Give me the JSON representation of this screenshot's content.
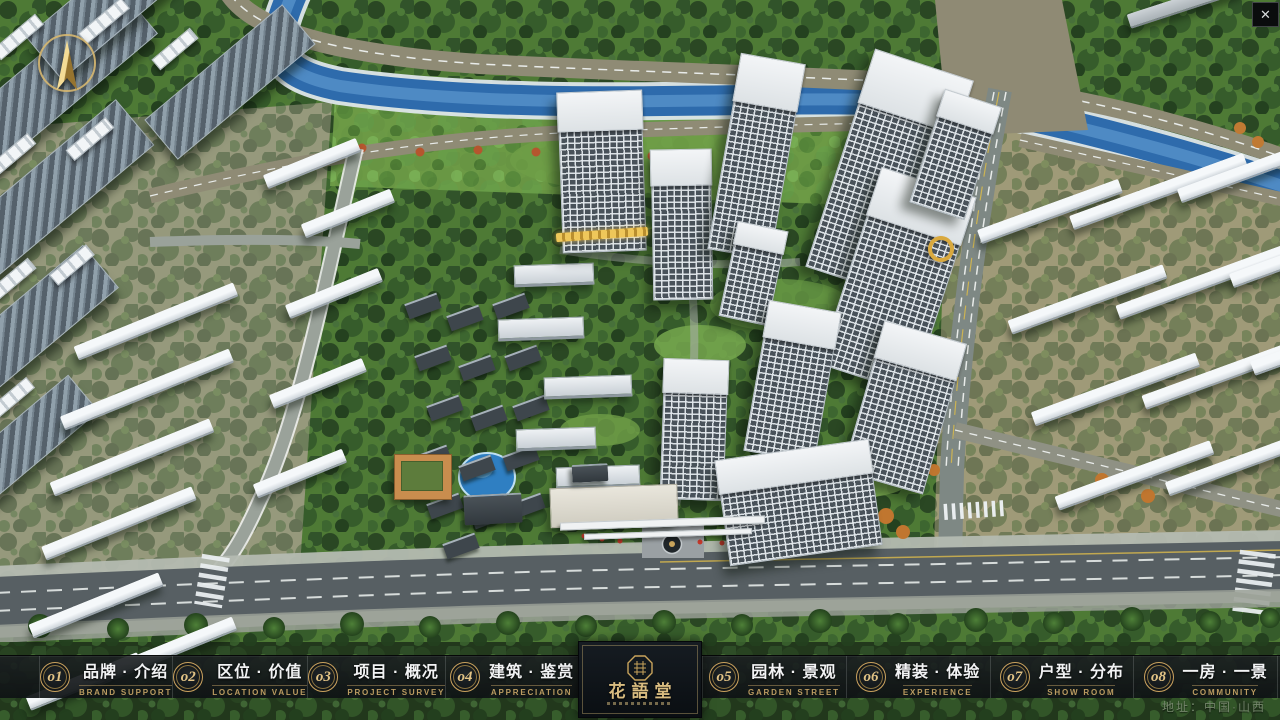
{
  "window": {
    "close_icon": "✕"
  },
  "nav": {
    "items": [
      {
        "num": "o1",
        "label_zh": "品牌 · 介绍",
        "label_en": "BRAND SUPPORT"
      },
      {
        "num": "o2",
        "label_zh": "区位 · 价值",
        "label_en": "LOCATION VALUE"
      },
      {
        "num": "o3",
        "label_zh": "项目 · 概况",
        "label_en": "PROJECT SURVEY"
      },
      {
        "num": "o4",
        "label_zh": "建筑 · 鉴赏",
        "label_en": "APPRECIATION"
      },
      {
        "num": "o5",
        "label_zh": "园林 · 景观",
        "label_en": "GARDEN STREET"
      },
      {
        "num": "o6",
        "label_zh": "精装 · 体验",
        "label_en": "EXPERIENCE"
      },
      {
        "num": "o7",
        "label_zh": "户型 · 分布",
        "label_en": "SHOW ROOM"
      },
      {
        "num": "o8",
        "label_zh": "一房 · 一景",
        "label_en": "COMMUNITY"
      }
    ],
    "logo_title": "花語堂",
    "address": "地址：中国·山西"
  },
  "colors": {
    "gold_accent": "#d3b377",
    "gold_dark": "#8a7340",
    "navbar_bg": "#14181a",
    "river_blue": "#2e6bac",
    "tree_green": "#2c5124"
  }
}
